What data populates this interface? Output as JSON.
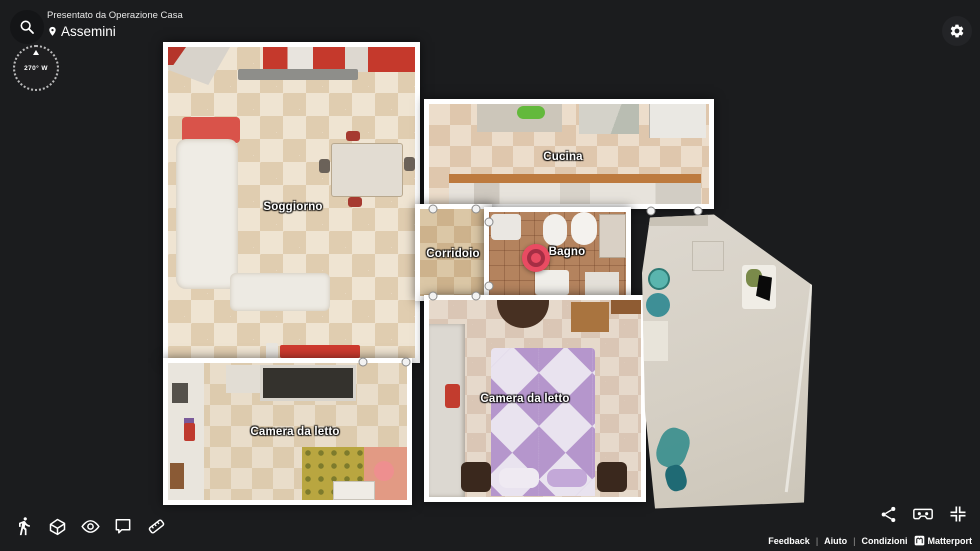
{
  "app": {
    "background_color": "#1b1c1e",
    "wall_color": "#ffffff"
  },
  "header": {
    "presented_by": "Presentato da Operazione Casa",
    "location": "Assemini"
  },
  "compass": {
    "heading": "270° W"
  },
  "floorplan": {
    "rooms": [
      {
        "id": "soggiorno",
        "label": "Soggiorno"
      },
      {
        "id": "cucina",
        "label": "Cucina"
      },
      {
        "id": "corridoio",
        "label": "Corridoio"
      },
      {
        "id": "bagno",
        "label": "Bagno"
      },
      {
        "id": "camera-da-letto-1",
        "label": "Camera da letto"
      },
      {
        "id": "camera-da-letto-2",
        "label": "Camera da letto"
      }
    ],
    "position_marker": {
      "outer_color": "#e94b62",
      "ring_color": "#a52e44"
    }
  },
  "toolbar": {
    "top_left_icons": [
      "search-icon",
      "location-pin-icon"
    ],
    "top_right_icons": [
      "settings-gear-icon"
    ],
    "bottom_left_icons": [
      "walk-icon",
      "dollhouse-icon",
      "highlights-eye-icon",
      "comment-icon",
      "measure-icon"
    ],
    "bottom_right_icons": [
      "share-icon",
      "vr-headset-icon",
      "fullscreen-icon"
    ]
  },
  "footer": {
    "links": [
      "Feedback",
      "Aiuto",
      "Condizioni"
    ],
    "separator": "|",
    "brand": "Matterport"
  }
}
